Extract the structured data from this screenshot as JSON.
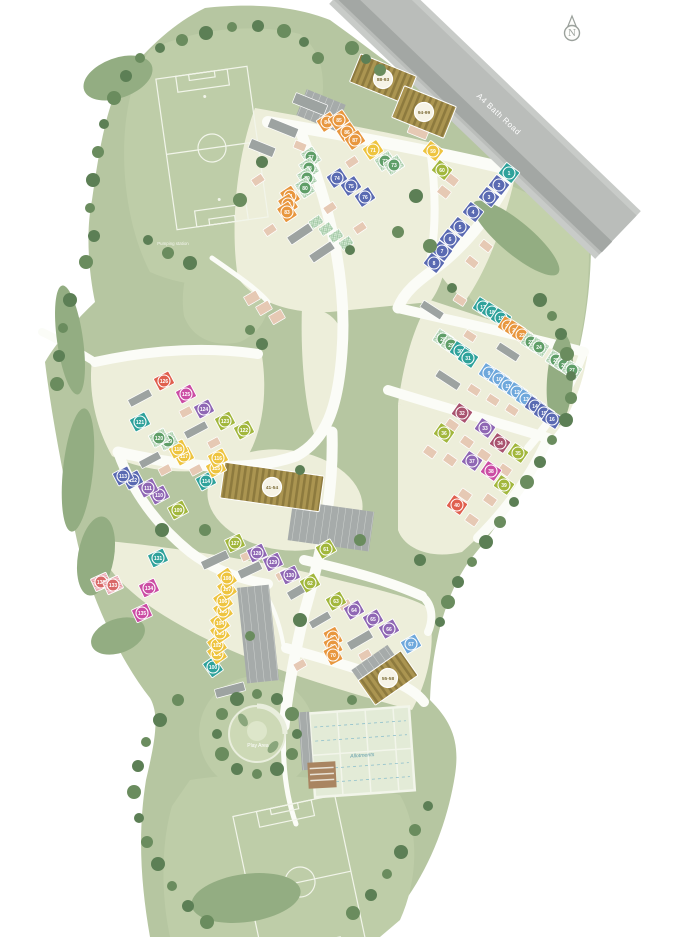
{
  "labels": {
    "road": "A4 Bath Road",
    "north": "N",
    "pumping_station": "Pumping station",
    "play_area": "Play Area",
    "allotments": "Allotments"
  },
  "colors": {
    "or": {
      "f": "#e8973f",
      "m": "#e8973f"
    },
    "bl": {
      "f": "#5a6ab2",
      "m": "#5a6ab2"
    },
    "lb": {
      "f": "#6fa8dc",
      "m": "#6fa8dc"
    },
    "tl": {
      "f": "#2fa29b",
      "m": "#2fa29b"
    },
    "gn": {
      "f": "pattern:hatchG",
      "m": "#5f9e68"
    },
    "ol": {
      "f": "#a2b73d",
      "m": "#a2b73d"
    },
    "yl": {
      "f": "#eec43f",
      "m": "#eec43f"
    },
    "pu": {
      "f": "#8f67b4",
      "m": "#8f67b4"
    },
    "mg": {
      "f": "#cb4da4",
      "m": "#cb4da4"
    },
    "rd": {
      "f": "#e05f4e",
      "m": "#e05f4e"
    },
    "mr": {
      "f": "#a9536f",
      "m": "#a9536f"
    },
    "pk": {
      "f": "pattern:hatchP",
      "m": "#d96868"
    }
  },
  "terrain": {
    "park": "#b6c6a1",
    "field": "#becda8",
    "wedge": "#c3d1ab",
    "estate": "#edeeda",
    "road_white": "#fbfcf7",
    "a4_light": "#babdba",
    "a4_dark": "#a3a7a4",
    "a4_verge": "#c8cbc8",
    "parking": "#a6abaa",
    "tree": "#5c7f55",
    "tree2": "#6a8c5e",
    "shrub": "#93ad82",
    "apt": "#ab9551",
    "pitchline": "#f2f5ea"
  },
  "apartments": [
    {
      "range": "88-93",
      "x": 383,
      "y": 79,
      "a": 22,
      "w": 60,
      "h": 30
    },
    {
      "range": "94-99",
      "x": 424,
      "y": 112,
      "a": 22,
      "w": 56,
      "h": 34
    },
    {
      "range": "41-54",
      "x": 272,
      "y": 487,
      "a": 8,
      "w": 100,
      "h": 36
    },
    {
      "range": "55-58",
      "x": 388,
      "y": 678,
      "a": -35,
      "w": 52,
      "h": 30
    }
  ],
  "plots": [
    {
      "n": 1,
      "c": "tl",
      "x": 509,
      "y": 173,
      "a": 38
    },
    {
      "n": 2,
      "c": "bl",
      "x": 499,
      "y": 185,
      "a": 38
    },
    {
      "n": 3,
      "c": "bl",
      "x": 489,
      "y": 197,
      "a": 38
    },
    {
      "n": 4,
      "c": "bl",
      "x": 473,
      "y": 212,
      "a": 38
    },
    {
      "n": 5,
      "c": "bl",
      "x": 460,
      "y": 227,
      "a": 38
    },
    {
      "n": 6,
      "c": "bl",
      "x": 450,
      "y": 239,
      "a": 38
    },
    {
      "n": 7,
      "c": "bl",
      "x": 442,
      "y": 251,
      "a": 38
    },
    {
      "n": 8,
      "c": "bl",
      "x": 434,
      "y": 263,
      "a": 38
    },
    {
      "n": 9,
      "c": "lb",
      "x": 489,
      "y": 373,
      "a": 33
    },
    {
      "n": 10,
      "c": "lb",
      "x": 499,
      "y": 379,
      "a": 33
    },
    {
      "n": 11,
      "c": "lb",
      "x": 508,
      "y": 386,
      "a": 33
    },
    {
      "n": 12,
      "c": "lb",
      "x": 517,
      "y": 392,
      "a": 33
    },
    {
      "n": 13,
      "c": "lb",
      "x": 526,
      "y": 399,
      "a": 33
    },
    {
      "n": 14,
      "c": "bl",
      "x": 535,
      "y": 406,
      "a": 33
    },
    {
      "n": 15,
      "c": "bl",
      "x": 544,
      "y": 413,
      "a": 33
    },
    {
      "n": 16,
      "c": "bl",
      "x": 552,
      "y": 419,
      "a": 33
    },
    {
      "n": 17,
      "c": "tl",
      "x": 483,
      "y": 307,
      "a": 33
    },
    {
      "n": 18,
      "c": "tl",
      "x": 492,
      "y": 312,
      "a": 33
    },
    {
      "n": 19,
      "c": "tl",
      "x": 501,
      "y": 318,
      "a": 33
    },
    {
      "n": 20,
      "c": "or",
      "x": 508,
      "y": 326,
      "a": 33
    },
    {
      "n": 21,
      "c": "or",
      "x": 515,
      "y": 330,
      "a": 33
    },
    {
      "n": 22,
      "c": "or",
      "x": 522,
      "y": 335,
      "a": 33
    },
    {
      "n": 23,
      "c": "gn",
      "x": 531,
      "y": 342,
      "a": 33
    },
    {
      "n": 24,
      "c": "gn",
      "x": 539,
      "y": 347,
      "a": 33
    },
    {
      "n": 25,
      "c": "gn",
      "x": 556,
      "y": 360,
      "a": 33
    },
    {
      "n": 26,
      "c": "gn",
      "x": 564,
      "y": 365,
      "a": 33
    },
    {
      "n": 27,
      "c": "gn",
      "x": 572,
      "y": 370,
      "a": 33
    },
    {
      "n": 28,
      "c": "gn",
      "x": 443,
      "y": 339,
      "a": 33
    },
    {
      "n": 29,
      "c": "gn",
      "x": 451,
      "y": 345,
      "a": 33
    },
    {
      "n": 30,
      "c": "tl",
      "x": 460,
      "y": 351,
      "a": 33
    },
    {
      "n": 31,
      "c": "tl",
      "x": 468,
      "y": 358,
      "a": 33
    },
    {
      "n": 32,
      "c": "mr",
      "x": 462,
      "y": 413,
      "a": 35
    },
    {
      "n": 33,
      "c": "pu",
      "x": 485,
      "y": 428,
      "a": 35
    },
    {
      "n": 34,
      "c": "mr",
      "x": 500,
      "y": 443,
      "a": 35
    },
    {
      "n": 35,
      "c": "ol",
      "x": 518,
      "y": 453,
      "a": 35
    },
    {
      "n": 36,
      "c": "ol",
      "x": 444,
      "y": 433,
      "a": 35
    },
    {
      "n": 37,
      "c": "pu",
      "x": 472,
      "y": 461,
      "a": 35
    },
    {
      "n": 38,
      "c": "mg",
      "x": 491,
      "y": 471,
      "a": 35
    },
    {
      "n": 39,
      "c": "ol",
      "x": 504,
      "y": 485,
      "a": 35
    },
    {
      "n": 40,
      "c": "rd",
      "x": 457,
      "y": 505,
      "a": 35
    },
    {
      "n": 59,
      "c": "yl",
      "x": 433,
      "y": 151,
      "a": 38
    },
    {
      "n": 60,
      "c": "ol",
      "x": 442,
      "y": 170,
      "a": 38
    },
    {
      "n": 61,
      "c": "ol",
      "x": 326,
      "y": 549,
      "a": -30
    },
    {
      "n": 62,
      "c": "ol",
      "x": 310,
      "y": 583,
      "a": -30
    },
    {
      "n": 63,
      "c": "ol",
      "x": 336,
      "y": 601,
      "a": -30
    },
    {
      "n": 64,
      "c": "pu",
      "x": 354,
      "y": 610,
      "a": -30
    },
    {
      "n": 65,
      "c": "pu",
      "x": 373,
      "y": 619,
      "a": -30
    },
    {
      "n": 66,
      "c": "pu",
      "x": 389,
      "y": 629,
      "a": -30
    },
    {
      "n": 67,
      "c": "lb",
      "x": 411,
      "y": 644,
      "a": -30
    },
    {
      "n": 68,
      "c": "or",
      "x": 333,
      "y": 637,
      "a": 62
    },
    {
      "n": 69,
      "c": "or",
      "x": 333,
      "y": 646,
      "a": 62
    },
    {
      "n": 70,
      "c": "or",
      "x": 333,
      "y": 655,
      "a": 62
    },
    {
      "n": 71,
      "c": "yl",
      "x": 373,
      "y": 150,
      "a": -34
    },
    {
      "n": 72,
      "c": "gn",
      "x": 385,
      "y": 161,
      "a": -34
    },
    {
      "n": 73,
      "c": "gn",
      "x": 394,
      "y": 165,
      "a": -34
    },
    {
      "n": 74,
      "c": "bl",
      "x": 337,
      "y": 178,
      "a": -34
    },
    {
      "n": 75,
      "c": "bl",
      "x": 351,
      "y": 186,
      "a": -34
    },
    {
      "n": 76,
      "c": "bl",
      "x": 365,
      "y": 197,
      "a": -34
    },
    {
      "n": 77,
      "c": "gn",
      "x": 311,
      "y": 157,
      "a": 56
    },
    {
      "n": 78,
      "c": "gn",
      "x": 309,
      "y": 168,
      "a": 56
    },
    {
      "n": 79,
      "c": "gn",
      "x": 307,
      "y": 178,
      "a": 56
    },
    {
      "n": 80,
      "c": "gn",
      "x": 305,
      "y": 188,
      "a": 56
    },
    {
      "n": 81,
      "c": "or",
      "x": 290,
      "y": 196,
      "a": 56
    },
    {
      "n": 82,
      "c": "or",
      "x": 288,
      "y": 204,
      "a": 56
    },
    {
      "n": 83,
      "c": "or",
      "x": 287,
      "y": 212,
      "a": 56
    },
    {
      "n": 84,
      "c": "or",
      "x": 327,
      "y": 122,
      "a": -34
    },
    {
      "n": 85,
      "c": "or",
      "x": 339,
      "y": 120,
      "a": -34
    },
    {
      "n": 86,
      "c": "or",
      "x": 347,
      "y": 132,
      "a": -34
    },
    {
      "n": 87,
      "c": "or",
      "x": 355,
      "y": 140,
      "a": -34
    },
    {
      "n": 100,
      "c": "tl",
      "x": 213,
      "y": 667,
      "a": 55
    },
    {
      "n": 101,
      "c": "yl",
      "x": 217,
      "y": 654,
      "a": 55
    },
    {
      "n": 102,
      "c": "yl",
      "x": 217,
      "y": 645,
      "a": 55
    },
    {
      "n": 103,
      "c": "yl",
      "x": 220,
      "y": 633,
      "a": 55
    },
    {
      "n": 104,
      "c": "yl",
      "x": 220,
      "y": 623,
      "a": 55
    },
    {
      "n": 105,
      "c": "yl",
      "x": 223,
      "y": 611,
      "a": 55
    },
    {
      "n": 106,
      "c": "yl",
      "x": 223,
      "y": 601,
      "a": 55
    },
    {
      "n": 107,
      "c": "yl",
      "x": 227,
      "y": 589,
      "a": 55
    },
    {
      "n": 108,
      "c": "yl",
      "x": 227,
      "y": 578,
      "a": 55
    },
    {
      "n": 109,
      "c": "ol",
      "x": 178,
      "y": 510,
      "a": -28
    },
    {
      "n": 110,
      "c": "pu",
      "x": 159,
      "y": 495,
      "a": -28
    },
    {
      "n": 111,
      "c": "pu",
      "x": 148,
      "y": 488,
      "a": -28
    },
    {
      "n": 112,
      "c": "bl",
      "x": 133,
      "y": 480,
      "a": -28
    },
    {
      "n": 113,
      "c": "bl",
      "x": 123,
      "y": 476,
      "a": -28
    },
    {
      "n": 114,
      "c": "tl",
      "x": 206,
      "y": 481,
      "a": -28
    },
    {
      "n": 115,
      "c": "yl",
      "x": 216,
      "y": 468,
      "a": -28
    },
    {
      "n": 116,
      "c": "yl",
      "x": 218,
      "y": 458,
      "a": -28
    },
    {
      "n": 117,
      "c": "yl",
      "x": 184,
      "y": 456,
      "a": -28
    },
    {
      "n": 118,
      "c": "yl",
      "x": 178,
      "y": 449,
      "a": -28
    },
    {
      "n": 119,
      "c": "gn",
      "x": 168,
      "y": 441,
      "a": -28
    },
    {
      "n": 120,
      "c": "gn",
      "x": 159,
      "y": 438,
      "a": -28
    },
    {
      "n": 121,
      "c": "tl",
      "x": 140,
      "y": 422,
      "a": -28
    },
    {
      "n": 122,
      "c": "ol",
      "x": 244,
      "y": 430,
      "a": -28
    },
    {
      "n": 123,
      "c": "ol",
      "x": 225,
      "y": 421,
      "a": -28
    },
    {
      "n": 124,
      "c": "pu",
      "x": 204,
      "y": 409,
      "a": -28
    },
    {
      "n": 125,
      "c": "mg",
      "x": 186,
      "y": 394,
      "a": -28
    },
    {
      "n": 126,
      "c": "rd",
      "x": 164,
      "y": 381,
      "a": -28
    },
    {
      "n": 127,
      "c": "ol",
      "x": 235,
      "y": 543,
      "a": -25
    },
    {
      "n": 128,
      "c": "pu",
      "x": 257,
      "y": 553,
      "a": -25
    },
    {
      "n": 129,
      "c": "pu",
      "x": 273,
      "y": 562,
      "a": -25
    },
    {
      "n": 130,
      "c": "pu",
      "x": 290,
      "y": 575,
      "a": -25
    },
    {
      "n": 131,
      "c": "tl",
      "x": 158,
      "y": 558,
      "a": -25
    },
    {
      "n": 132,
      "c": "pk",
      "x": 101,
      "y": 582,
      "a": -25
    },
    {
      "n": 133,
      "c": "pk",
      "x": 113,
      "y": 585,
      "a": -25
    },
    {
      "n": 134,
      "c": "mg",
      "x": 149,
      "y": 588,
      "a": -25
    },
    {
      "n": 135,
      "c": "mg",
      "x": 142,
      "y": 613,
      "a": -25
    }
  ]
}
